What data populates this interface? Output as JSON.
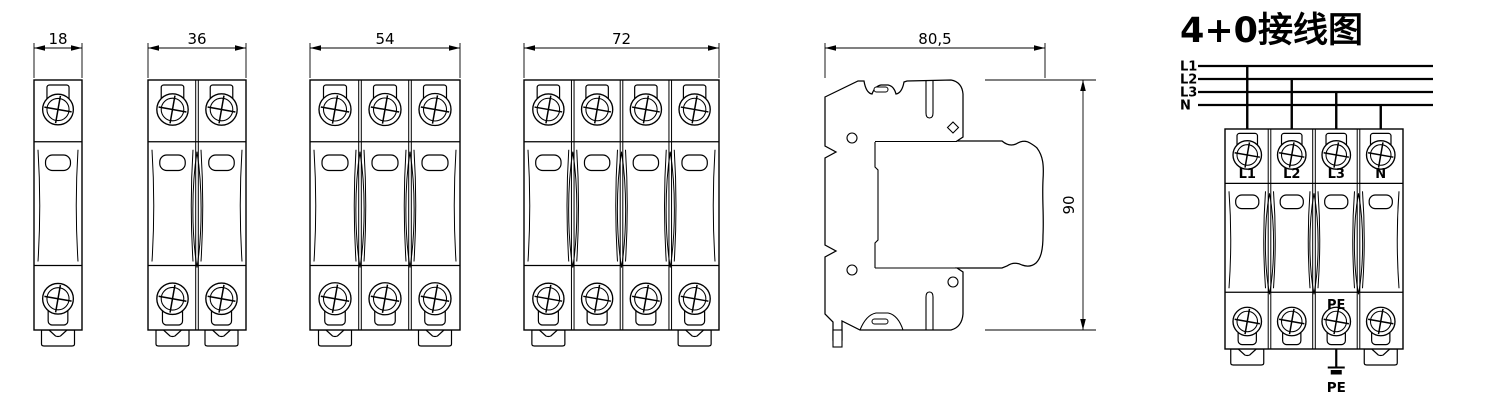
{
  "page": {
    "background": "#ffffff",
    "line_color": "#000000"
  },
  "front_views": [
    {
      "name": "front-view-1-pole",
      "poles": 1,
      "width_label": "18"
    },
    {
      "name": "front-view-2-pole",
      "poles": 2,
      "width_label": "36"
    },
    {
      "name": "front-view-3-pole",
      "poles": 3,
      "width_label": "54"
    },
    {
      "name": "front-view-4-pole",
      "poles": 4,
      "width_label": "72"
    }
  ],
  "side_view": {
    "width_label": "80,5",
    "height_label": "90"
  },
  "wiring": {
    "title": "4+0接线图",
    "poles": 4,
    "bus_labels": [
      "L1",
      "L2",
      "L3",
      "N"
    ],
    "pole_labels": [
      "L1",
      "L2",
      "L3",
      "N"
    ],
    "pe_label": "PE",
    "ground_label": "PE"
  }
}
